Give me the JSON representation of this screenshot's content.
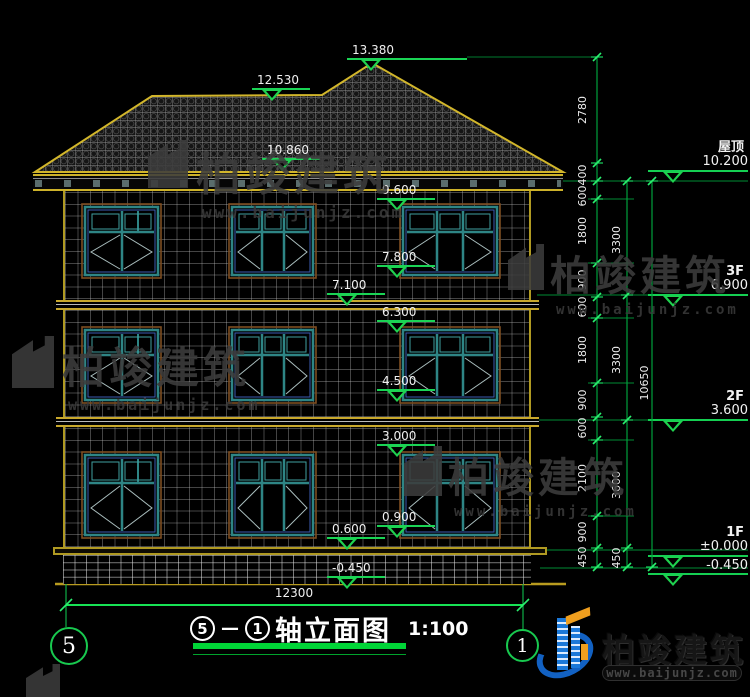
{
  "watermark": {
    "brand": "柏竣建筑",
    "url": "www.baijunjz.com"
  },
  "logo": {
    "brand": "柏竣建筑",
    "url": "www.baijunjz.com"
  },
  "facade_levels": {
    "ridge_peak": "13.380",
    "ridge_left": "12.530",
    "roof_mid": "10.860",
    "eave_top": "9.600",
    "w3_bottom": "7.800",
    "slab_3f": "7.100",
    "w2_top": "6.300",
    "w2_bottom": "4.500",
    "w1_top": "3.000",
    "w1_bottom": "0.900",
    "plinth_top": "0.600",
    "ground": "-0.450"
  },
  "right_levels": [
    {
      "name": "屋顶",
      "value": "10.200"
    },
    {
      "name": "3F",
      "value": "6.900"
    },
    {
      "name": "2F",
      "value": "3.600"
    },
    {
      "name": "1F",
      "value": "±0.000"
    },
    {
      "name": "",
      "value": "-0.450"
    }
  ],
  "dims": {
    "chain1": [
      "2780",
      "400",
      "600",
      "1800",
      "900",
      "600",
      "1800",
      "900",
      "600",
      "2100",
      "900",
      "450"
    ],
    "chain2": [
      "3300",
      "3300",
      "3600",
      "450"
    ],
    "overall_height": "10650",
    "overall_width": "12300"
  },
  "title_block": {
    "axis_start": "5",
    "axis_end": "1",
    "separator": "—",
    "name": "轴立面图",
    "scale": "1:100"
  },
  "grid_bubbles": {
    "left": "5",
    "right": "1"
  }
}
